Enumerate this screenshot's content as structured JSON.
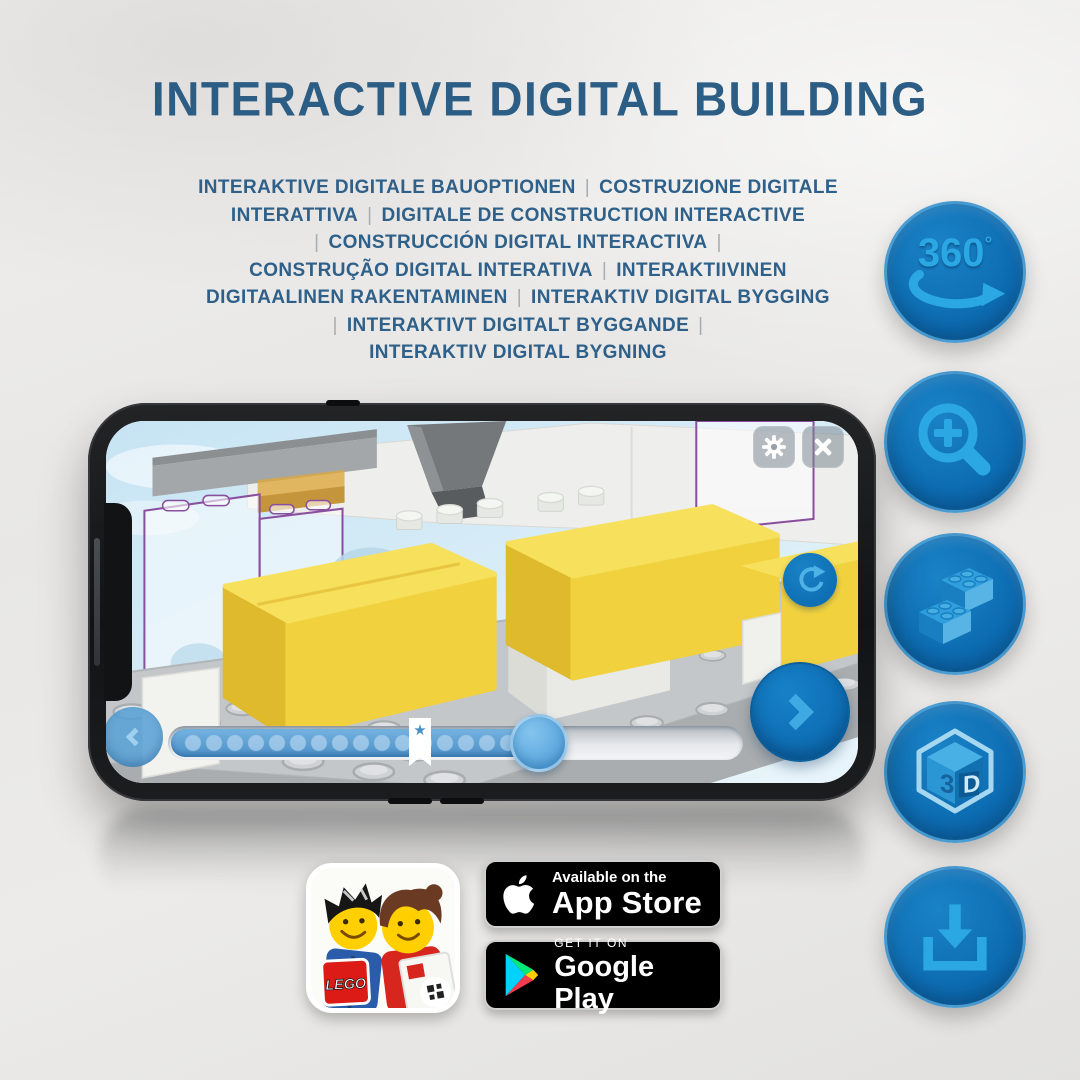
{
  "header": {
    "title": "INTERACTIVE DIGITAL BUILDING"
  },
  "subtitle": {
    "lines": [
      "INTERAKTIVE DIGITALE BAUOPTIONEN | COSTRUZIONE DIGITALE",
      "INTERATTIVA | DIGITALE DE CONSTRUCTION INTERACTIVE",
      "| CONSTRUCCIÓN DIGITAL INTERACTIVA |",
      "CONSTRUÇÃO DIGITAL INTERATIVA | INTERAKTIIVINEN",
      "DIGITAALINEN RAKENTAMINEN | INTERAKTIV DIGITAL BYGGING",
      "| INTERAKTIVT DIGITALT BYGGANDE |",
      "INTERAKTIV DIGITAL BYGNING"
    ]
  },
  "features": [
    {
      "id": "rotate-360",
      "label": "360",
      "sup": "°"
    },
    {
      "id": "zoom-in"
    },
    {
      "id": "stack-bricks"
    },
    {
      "id": "view-3d",
      "cube_left": "3",
      "cube_right": "D"
    },
    {
      "id": "download"
    }
  ],
  "glyphs": {
    "star": "★"
  },
  "app": {
    "icon_brand": "LEGO"
  },
  "stores": {
    "app_store": {
      "tagline": "Available on the",
      "name": "App Store"
    },
    "google_play": {
      "tagline": "GET IT ON",
      "name": "Google Play"
    }
  },
  "colors": {
    "title_blue": "#2c5d84",
    "circle_blue": "#0e71b8",
    "icon_light_blue": "#2ba7e3",
    "screen_sky": "#cfe7f5",
    "brick_yellow": "#f2d64a",
    "lego_red": "#d6231c"
  }
}
